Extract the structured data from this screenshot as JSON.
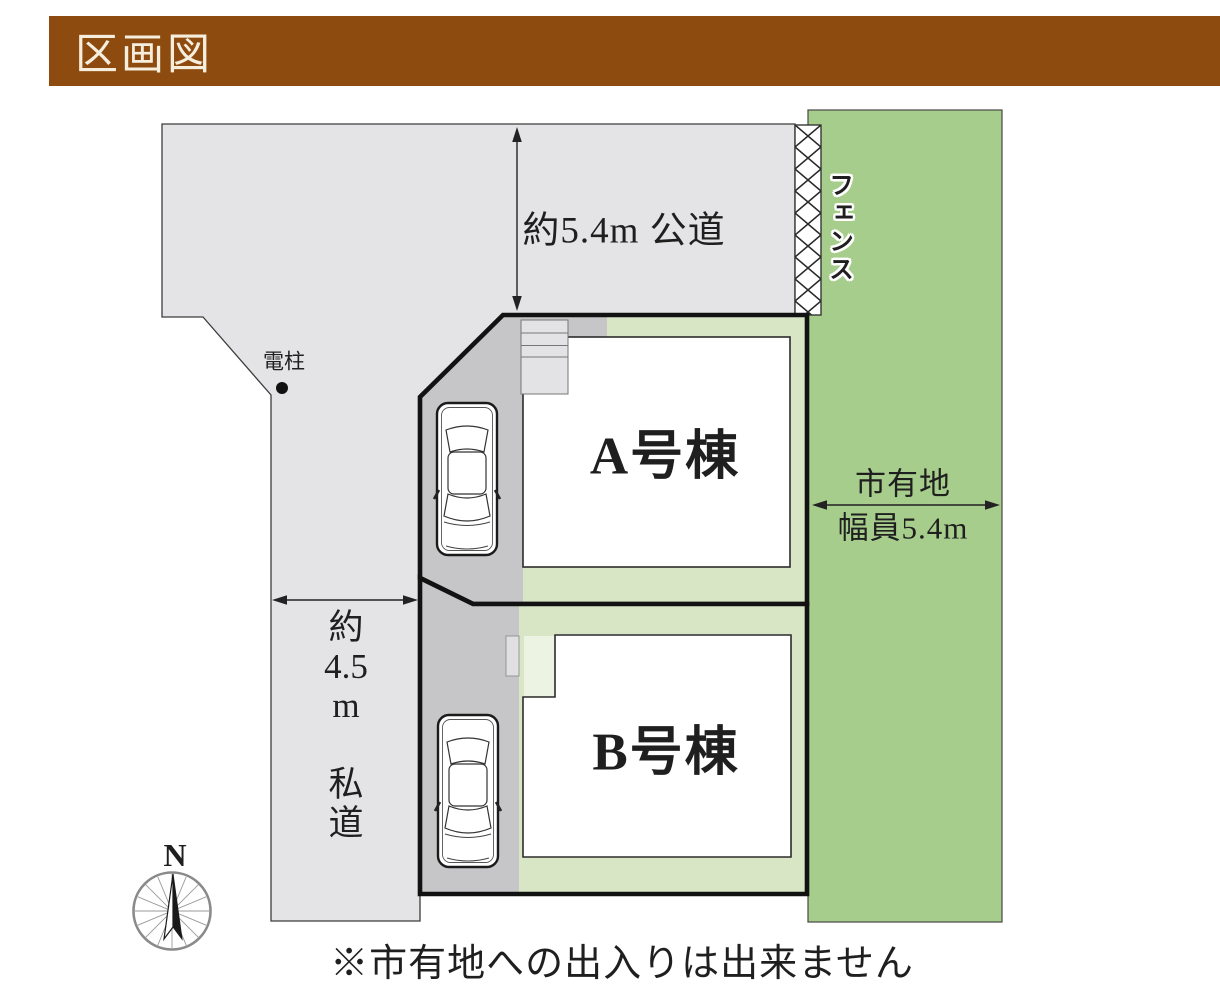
{
  "header": {
    "title": "区画図"
  },
  "colors": {
    "header-brown": "#8d4b10",
    "header-text": "#f6eedd",
    "road-gray": "#e4e4e6",
    "driveway-gray": "#c6c6c8",
    "yard-green": "#d8e6c6",
    "yard-green-pale": "#ecf3e3",
    "city-green": "#a7cd8d",
    "ink": "#1f1f1f"
  },
  "diagram": {
    "top_road": {
      "label": "約5.4m 公道"
    },
    "left_road": {
      "label_lines": [
        "約",
        "4.5",
        "m",
        "",
        "私",
        "道"
      ]
    },
    "utility_pole": {
      "label": "電柱"
    },
    "fence": {
      "label": "フェンス"
    },
    "city_land": {
      "name": "市有地",
      "width": "幅員5.4m"
    },
    "plots": {
      "a": {
        "label": "A号棟"
      },
      "b": {
        "label": "B号棟"
      }
    },
    "compass": {
      "north": "N"
    },
    "note": "※市有地への出入りは出来ません"
  }
}
